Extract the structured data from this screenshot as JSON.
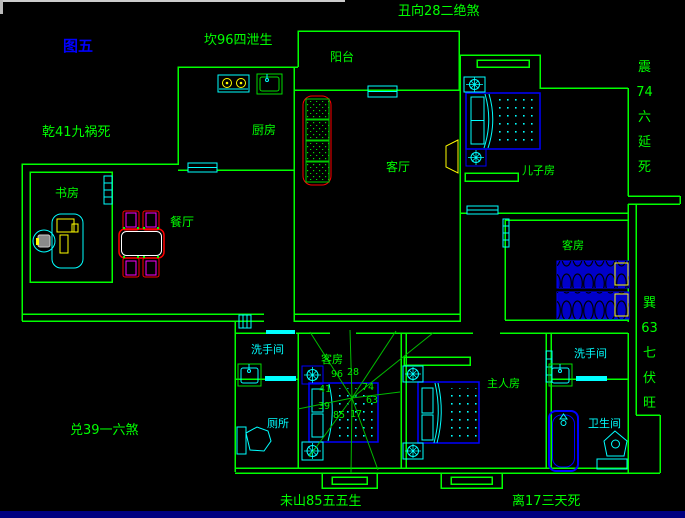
{
  "figure_label": "图五",
  "annotations": {
    "kan": "坎96四泄生",
    "chou": "丑向28二绝煞",
    "qian": "乾41九祸死",
    "zhen": "震74六延死",
    "xun": "巽63七伏旺",
    "dui": "兑39一六煞",
    "weishan": "未山85五五生",
    "li": "离17三天死"
  },
  "rooms": {
    "balcony": "阳台",
    "kitchen": "厨房",
    "living": "客厅",
    "kids": "儿子房",
    "guest_right": "客房",
    "study": "书房",
    "dining": "餐厅",
    "guest_center": "客房",
    "master": "主人房",
    "washroom_left": "洗手间",
    "toilet": "厕所",
    "washroom_right": "洗手间",
    "bathroom": "卫生间"
  },
  "compass": {
    "n96": "96",
    "n28": "28",
    "n74": "74",
    "n63": "63",
    "n17": "17",
    "n85": "85",
    "n39": "39",
    "n41": "41"
  },
  "colors": {
    "wall": "#00ff00",
    "fixture": "#00ffff",
    "furniture": "#0000ff",
    "sofa_table": "#ff0000",
    "chair": "#ff00ff",
    "appliance": "#ffff00",
    "figure_label": "#0000ff",
    "window_edge": "#000080"
  }
}
